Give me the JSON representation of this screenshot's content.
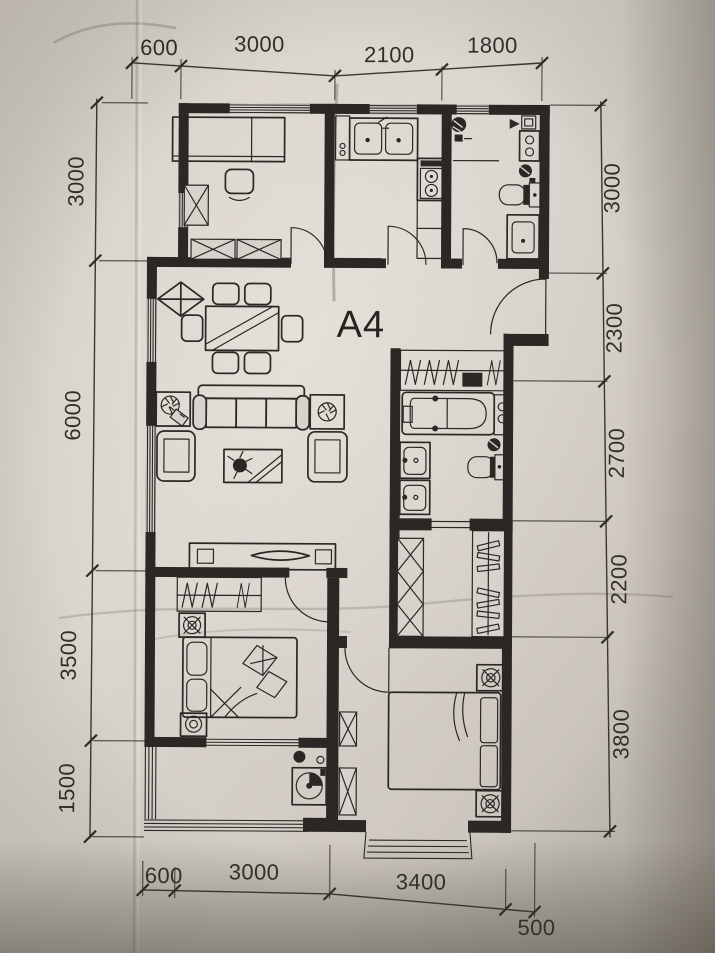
{
  "floor_plan": {
    "unit_label": "A4",
    "dims": {
      "top": [
        "600",
        "3000",
        "2100",
        "1800"
      ],
      "left": [
        "3000",
        "6000",
        "3500",
        "1500"
      ],
      "right": [
        "3000",
        "2300",
        "2700",
        "2200",
        "3800"
      ],
      "bottom": [
        "600",
        "3000",
        "3400",
        "500"
      ]
    },
    "colors": {
      "paper": "#d7d2cb",
      "ink": "#2b2724"
    }
  }
}
